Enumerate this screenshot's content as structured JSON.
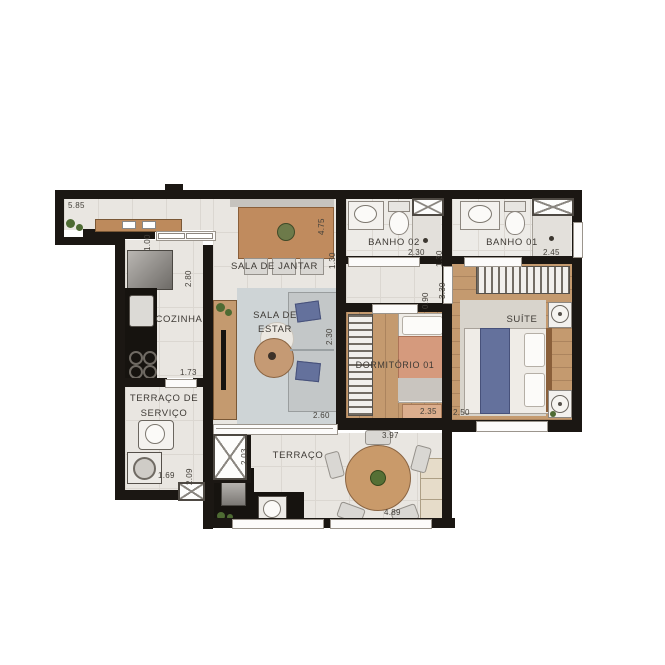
{
  "plan": {
    "type": "apartment-floor-plan",
    "units": "meters"
  },
  "rooms": {
    "sala_jantar": {
      "label": "SALA DE JANTAR"
    },
    "cozinha": {
      "label": "COZINHA"
    },
    "sala_estar": {
      "line1": "SALA DE",
      "line2": "ESTAR"
    },
    "banho02": {
      "label": "BANHO 02"
    },
    "banho01": {
      "label": "BANHO 01"
    },
    "suite": {
      "label": "SUÍTE"
    },
    "dormitorio01": {
      "label": "DORMITÓRIO 01"
    },
    "terraco_servico": {
      "line1": "TERRAÇO DE",
      "line2": "SERVIÇO"
    },
    "terraco": {
      "label": "TERRAÇO"
    }
  },
  "dims": {
    "entry": "5.85",
    "hall_width": "1.00",
    "cozinha_len": "2.80",
    "jantar_len": "4.75",
    "banho02_w": "1.30",
    "banho02_len": "2.30",
    "banho01_w": "1.30",
    "banho01_len": "2.45",
    "suite_len": "3.30",
    "corridor_w": "0.90",
    "dorm_closet": "2.30",
    "estar_w": "2.60",
    "dorm_w": "2.35",
    "suite_w": "2.50",
    "cozinha_w": "1.73",
    "servico_len": "2.09",
    "servico_w": "1.69",
    "terraco_h": "2.03",
    "dorm_len": "3.97",
    "terraco_len": "4.89"
  },
  "colors": {
    "wall": "#1b1713",
    "floor_tile": "#e9e6e1",
    "wood": "#c49a6f",
    "counter": "#16130f",
    "bed_blue": "#64719c",
    "bed_salmon": "#d59a7d",
    "table_wood": "#c08b5e"
  }
}
